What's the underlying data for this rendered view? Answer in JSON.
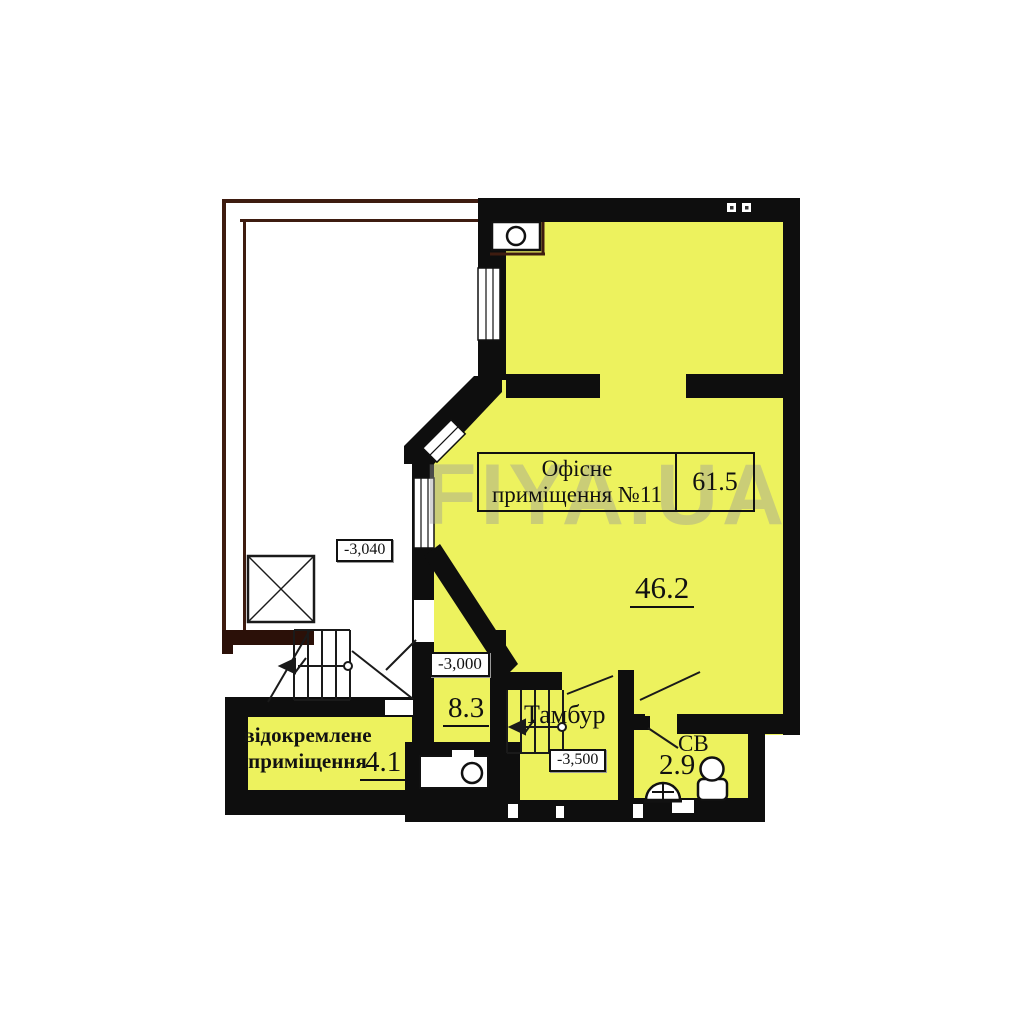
{
  "watermark": "FIYA.UA",
  "colors": {
    "room_fill": "#edf25e",
    "wall": "#0e0e0e",
    "terrace_line": "#3e1c10",
    "watermark_gray": "#9b9b9b"
  },
  "title_block": {
    "name_line1": "Офісне",
    "name_line2": "приміщення №11",
    "total_area": "61.5"
  },
  "rooms": {
    "office": {
      "area": "46.2"
    },
    "room_8_3": {
      "area": "8.3",
      "elevation": "-3,000"
    },
    "tambour": {
      "name": "Тамбур",
      "elevation": "-3,500"
    },
    "bathroom": {
      "name": "СВ",
      "area": "2.9"
    },
    "detached": {
      "name_line1": "відокремлене",
      "name_line2": "приміщення",
      "area": "4.1"
    },
    "terrace": {
      "elevation": "-3,040"
    }
  }
}
